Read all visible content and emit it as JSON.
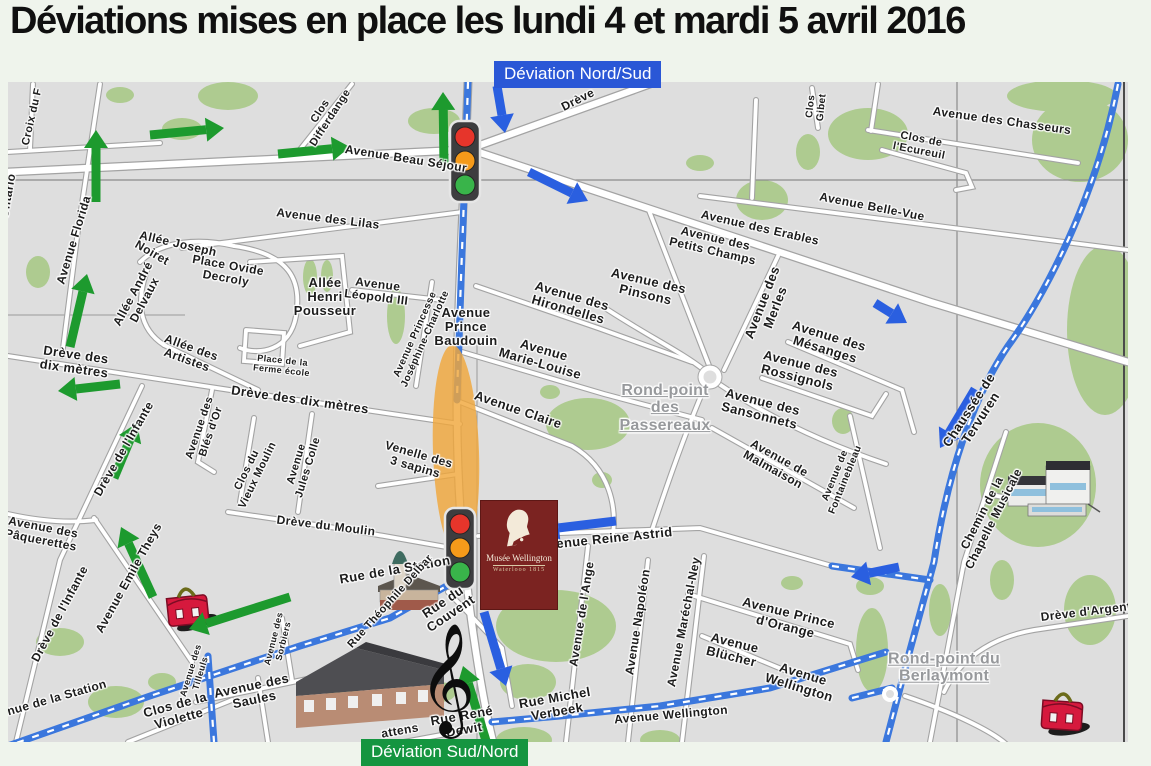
{
  "title": "Déviations mises en place les lundi 4 et mardi 5 avril 2016",
  "badges": {
    "nord_sud": "Déviation Nord/Sud",
    "sud_nord": "Déviation Sud/Nord"
  },
  "museum_badge": {
    "line1": "Musée Wellington",
    "line2": "Waterlooo 1815"
  },
  "colors": {
    "deviation_blue_badge": "#2a57d6",
    "deviation_green_badge": "#159540",
    "arrow_green": "#1d9a2e",
    "arrow_blue": "#2a5fe0",
    "road_blue": "#3b77dd",
    "highlight_orange": "#f0a73c",
    "map_background": "#dedede",
    "green_area": "#aecb90"
  },
  "icons": [
    "traffic-light-icon",
    "schoolbag-icon",
    "church-icon",
    "school-building-icon",
    "concert-hall-icon",
    "treble-clef-icon",
    "highlight-ellipse",
    "roundabout"
  ],
  "map": {
    "treble_clef_glyph": "𝄞",
    "labels": [
      {
        "lines": [
          "Croix du F"
        ],
        "x": 33,
        "y": 117,
        "rot": -77,
        "fs": 11
      },
      {
        "lines": [
          "Ontario"
        ],
        "x": 8,
        "y": 196,
        "rot": -80,
        "fs": 12
      },
      {
        "lines": [
          "Avenue Florida"
        ],
        "x": 74,
        "y": 240,
        "rot": -73,
        "fs": 12
      },
      {
        "lines": [
          "Clos",
          "Differdange"
        ],
        "x": 326,
        "y": 115,
        "rot": -57,
        "fs": 11
      },
      {
        "lines": [
          "Avenue Beau Séjour"
        ],
        "x": 406,
        "y": 159,
        "rot": 9,
        "fs": 12
      },
      {
        "lines": [
          "Drève"
        ],
        "x": 578,
        "y": 100,
        "rot": -27,
        "fs": 12
      },
      {
        "lines": [
          "Clos",
          "Gibet"
        ],
        "x": 817,
        "y": 107,
        "rot": -84,
        "fs": 10
      },
      {
        "lines": [
          "Avenue des Chasseurs"
        ],
        "x": 1002,
        "y": 121,
        "rot": 8,
        "fs": 12
      },
      {
        "lines": [
          "Clos de",
          "l'Ecureuil"
        ],
        "x": 920,
        "y": 146,
        "rot": 11,
        "fs": 11
      },
      {
        "lines": [
          "Avenue Belle-Vue"
        ],
        "x": 872,
        "y": 207,
        "rot": 11,
        "fs": 12
      },
      {
        "lines": [
          "Avenue des Erables"
        ],
        "x": 760,
        "y": 228,
        "rot": 13,
        "fs": 12
      },
      {
        "lines": [
          "Avenue des",
          "Petits Champs"
        ],
        "x": 714,
        "y": 245,
        "rot": 13,
        "fs": 12
      },
      {
        "lines": [
          "Avenue des Lilas"
        ],
        "x": 328,
        "y": 219,
        "rot": 7,
        "fs": 12
      },
      {
        "lines": [
          "Allée Joseph"
        ],
        "x": 178,
        "y": 244,
        "rot": 13,
        "fs": 12
      },
      {
        "lines": [
          "Noiret"
        ],
        "x": 152,
        "y": 253,
        "rot": 30,
        "fs": 12
      },
      {
        "lines": [
          "Place Ovide",
          "Decroly"
        ],
        "x": 227,
        "y": 272,
        "rot": 10,
        "fs": 12
      },
      {
        "lines": [
          "Allée André",
          "Delvaux"
        ],
        "x": 139,
        "y": 297,
        "rot": -62,
        "fs": 12
      },
      {
        "lines": [
          "Allée des",
          "Artistes"
        ],
        "x": 189,
        "y": 354,
        "rot": 20,
        "fs": 12
      },
      {
        "lines": [
          "Allée",
          "Henri",
          "Pousseur"
        ],
        "x": 325,
        "y": 297,
        "rot": 0,
        "fs": 13
      },
      {
        "lines": [
          "Avenue",
          "Léopold III"
        ],
        "x": 377,
        "y": 291,
        "rot": 7,
        "fs": 12
      },
      {
        "lines": [
          "Avenue Princesse",
          "Joséphine-Charlotte"
        ],
        "x": 421,
        "y": 337,
        "rot": -66,
        "fs": 10
      },
      {
        "lines": [
          "Avenue",
          "Prince",
          "Baudouin"
        ],
        "x": 466,
        "y": 327,
        "rot": 0,
        "fs": 13
      },
      {
        "lines": [
          "Avenue des",
          "Hirondelles"
        ],
        "x": 570,
        "y": 303,
        "rot": 16,
        "fs": 13
      },
      {
        "lines": [
          "Avenue",
          "Marie-Louise"
        ],
        "x": 542,
        "y": 357,
        "rot": 16,
        "fs": 13
      },
      {
        "lines": [
          "Avenue Claire"
        ],
        "x": 518,
        "y": 410,
        "rot": 19,
        "fs": 13
      },
      {
        "lines": [
          "Venelle des",
          "3 sapins"
        ],
        "x": 417,
        "y": 461,
        "rot": 16,
        "fs": 12
      },
      {
        "lines": [
          "Rond-point",
          "des",
          "Passereaux"
        ],
        "x": 665,
        "y": 408,
        "rot": 0,
        "fs": 16,
        "cls": "gray"
      },
      {
        "lines": [
          "Avenue des",
          "Pinsons"
        ],
        "x": 647,
        "y": 288,
        "rot": 13,
        "fs": 13
      },
      {
        "lines": [
          "Avenue des",
          "Merles"
        ],
        "x": 769,
        "y": 305,
        "rot": -69,
        "fs": 13
      },
      {
        "lines": [
          "Avenue des",
          "Mésanges"
        ],
        "x": 827,
        "y": 343,
        "rot": 17,
        "fs": 13
      },
      {
        "lines": [
          "Avenue des",
          "Rossignols"
        ],
        "x": 799,
        "y": 371,
        "rot": 14,
        "fs": 13
      },
      {
        "lines": [
          "Avenue des",
          "Sansonnets"
        ],
        "x": 761,
        "y": 409,
        "rot": 14,
        "fs": 13
      },
      {
        "lines": [
          "Avenue de",
          "Malmaison"
        ],
        "x": 776,
        "y": 464,
        "rot": 29,
        "fs": 12
      },
      {
        "lines": [
          "Avenue de",
          "Fontainebleau"
        ],
        "x": 841,
        "y": 478,
        "rot": -68,
        "fs": 10
      },
      {
        "lines": [
          "Chaussée de",
          "Tervuren"
        ],
        "x": 975,
        "y": 414,
        "rot": -57,
        "fs": 13
      },
      {
        "lines": [
          "Chemin de la",
          "Chapelle Musicale"
        ],
        "x": 988,
        "y": 516,
        "rot": -63,
        "fs": 12
      },
      {
        "lines": [
          "Drève des",
          "dix mètres"
        ],
        "x": 75,
        "y": 362,
        "rot": 8,
        "fs": 13
      },
      {
        "lines": [
          "Drève des dix mètres"
        ],
        "x": 300,
        "y": 400,
        "rot": 8,
        "fs": 13
      },
      {
        "lines": [
          "Place de la",
          "Ferme école"
        ],
        "x": 282,
        "y": 366,
        "rot": 6,
        "fs": 9
      },
      {
        "lines": [
          "Drève de l'Infante"
        ],
        "x": 124,
        "y": 449,
        "rot": -60,
        "fs": 12
      },
      {
        "lines": [
          "Drève de l'Infante"
        ],
        "x": 60,
        "y": 614,
        "rot": -62,
        "fs": 12
      },
      {
        "lines": [
          "Avenue des",
          "Blés d'Or"
        ],
        "x": 206,
        "y": 430,
        "rot": -71,
        "fs": 11
      },
      {
        "lines": [
          "Clos du",
          "Vieux Moulin"
        ],
        "x": 253,
        "y": 473,
        "rot": -64,
        "fs": 11
      },
      {
        "lines": [
          "Avenue",
          "Jules Colle"
        ],
        "x": 303,
        "y": 466,
        "rot": -73,
        "fs": 11
      },
      {
        "lines": [
          "Drève du Moulin"
        ],
        "x": 326,
        "y": 526,
        "rot": 7,
        "fs": 12
      },
      {
        "lines": [
          "Avenue des",
          "Pâquerettes"
        ],
        "x": 42,
        "y": 534,
        "rot": 11,
        "fs": 12
      },
      {
        "lines": [
          "Avenue Emile Theys"
        ],
        "x": 129,
        "y": 578,
        "rot": -61,
        "fs": 12
      },
      {
        "lines": [
          "Avenue de la Station"
        ],
        "x": 46,
        "y": 701,
        "rot": -16,
        "fs": 12
      },
      {
        "lines": [
          "Avenue des",
          "Tilleuls"
        ],
        "x": 196,
        "y": 672,
        "rot": -73,
        "fs": 9
      },
      {
        "lines": [
          "Avenue des",
          "Sorbiers"
        ],
        "x": 279,
        "y": 640,
        "rot": -76,
        "fs": 9
      },
      {
        "lines": [
          "Avenue des",
          "Saules"
        ],
        "x": 253,
        "y": 693,
        "rot": -12,
        "fs": 13
      },
      {
        "lines": [
          "Clos de la",
          "Violette"
        ],
        "x": 177,
        "y": 712,
        "rot": -15,
        "fs": 13
      },
      {
        "lines": [
          "Rue de la Station"
        ],
        "x": 395,
        "y": 570,
        "rot": -10,
        "fs": 13
      },
      {
        "lines": [
          "Rue Théophile Delbar"
        ],
        "x": 391,
        "y": 602,
        "rot": -48,
        "fs": 11
      },
      {
        "lines": [
          "Rue du",
          "Couvent"
        ],
        "x": 447,
        "y": 608,
        "rot": -34,
        "fs": 13
      },
      {
        "lines": [
          "Avenue Reine Astrid"
        ],
        "x": 606,
        "y": 539,
        "rot": -6,
        "fs": 13
      },
      {
        "lines": [
          "Avenue de l'Ange"
        ],
        "x": 582,
        "y": 614,
        "rot": -81,
        "fs": 12
      },
      {
        "lines": [
          "Avenue Napoléon"
        ],
        "x": 638,
        "y": 622,
        "rot": -81,
        "fs": 12
      },
      {
        "lines": [
          "Avenue Maréchal-Ney"
        ],
        "x": 684,
        "y": 622,
        "rot": -79,
        "fs": 12
      },
      {
        "lines": [
          "Avenue Prince",
          "d'Orange"
        ],
        "x": 787,
        "y": 620,
        "rot": 14,
        "fs": 13
      },
      {
        "lines": [
          "Avenue",
          "Blücher"
        ],
        "x": 733,
        "y": 650,
        "rot": 14,
        "fs": 13
      },
      {
        "lines": [
          "Avenue",
          "Wellington"
        ],
        "x": 801,
        "y": 681,
        "rot": 17,
        "fs": 13
      },
      {
        "lines": [
          "Avenue Wellington"
        ],
        "x": 671,
        "y": 715,
        "rot": -5,
        "fs": 12
      },
      {
        "lines": [
          "Rue Michel",
          "Verbeek"
        ],
        "x": 556,
        "y": 705,
        "rot": -10,
        "fs": 13
      },
      {
        "lines": [
          "Rue René",
          "Dewit"
        ],
        "x": 463,
        "y": 723,
        "rot": -10,
        "fs": 13
      },
      {
        "lines": [
          "attens"
        ],
        "x": 400,
        "y": 731,
        "rot": -10,
        "fs": 12
      },
      {
        "lines": [
          "Rond-point du",
          "Berlaymont"
        ],
        "x": 944,
        "y": 668,
        "rot": 0,
        "fs": 16,
        "cls": "gray"
      },
      {
        "lines": [
          "Drève d'Argent"
        ],
        "x": 1086,
        "y": 612,
        "rot": -7,
        "fs": 12
      }
    ],
    "arrows": [
      {
        "color": "green",
        "x1": 96,
        "y1": 202,
        "x2": 96,
        "y2": 130
      },
      {
        "color": "green",
        "x1": 150,
        "y1": 135,
        "x2": 224,
        "y2": 128
      },
      {
        "color": "green",
        "x1": 278,
        "y1": 154,
        "x2": 350,
        "y2": 147
      },
      {
        "color": "green",
        "x1": 444,
        "y1": 165,
        "x2": 443,
        "y2": 92
      },
      {
        "color": "green",
        "x1": 70,
        "y1": 347,
        "x2": 87,
        "y2": 274
      },
      {
        "color": "green",
        "x1": 120,
        "y1": 384,
        "x2": 58,
        "y2": 391
      },
      {
        "color": "green",
        "x1": 114,
        "y1": 478,
        "x2": 137,
        "y2": 423
      },
      {
        "color": "green",
        "x1": 153,
        "y1": 597,
        "x2": 121,
        "y2": 527
      },
      {
        "color": "green",
        "x1": 290,
        "y1": 597,
        "x2": 189,
        "y2": 629
      },
      {
        "color": "green",
        "x1": 487,
        "y1": 744,
        "x2": 463,
        "y2": 666
      },
      {
        "color": "blue",
        "x1": 497,
        "y1": 86,
        "x2": 505,
        "y2": 133
      },
      {
        "color": "blue",
        "x1": 529,
        "y1": 172,
        "x2": 588,
        "y2": 201
      },
      {
        "color": "blue",
        "x1": 875,
        "y1": 303,
        "x2": 907,
        "y2": 323
      },
      {
        "color": "blue",
        "x1": 975,
        "y1": 389,
        "x2": 940,
        "y2": 448
      },
      {
        "color": "blue",
        "x1": 616,
        "y1": 521,
        "x2": 541,
        "y2": 530
      },
      {
        "color": "blue",
        "x1": 899,
        "y1": 567,
        "x2": 851,
        "y2": 577
      },
      {
        "color": "blue",
        "x1": 484,
        "y1": 612,
        "x2": 506,
        "y2": 686
      }
    ]
  }
}
